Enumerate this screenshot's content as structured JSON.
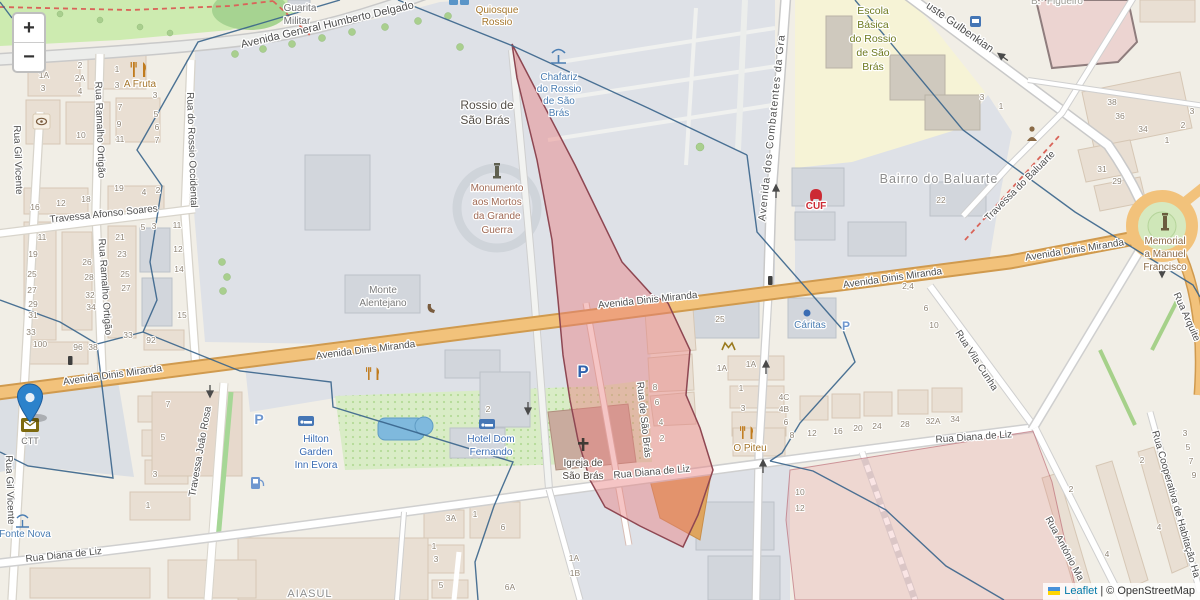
{
  "controls": {
    "zoom_in_label": "+",
    "zoom_out_label": "−"
  },
  "attribution": {
    "leaflet": "Leaflet",
    "sep": "|",
    "osm": "© OpenStreetMap"
  },
  "colors": {
    "base": "#f1eee6",
    "square_gray": "#dee1e7",
    "park_green": "#cdebb0",
    "school_yellow": "#f6f3d6",
    "road_primary": "#f2c27b",
    "pink_overlay": "#e87f7f",
    "pink_border": "#8e4752",
    "boundary_blue": "#38648b",
    "marker_blue": "#2c82cb"
  },
  "map_labels": [
    {
      "n": "street-humberto-delgado",
      "t": "Avenida General Humberto Delgado",
      "x": 328,
      "y": 28,
      "r": -13,
      "s": 11
    },
    {
      "n": "street-afonso-soares",
      "t": "Travessa Afonso Soares",
      "x": 104,
      "y": 217,
      "r": -6,
      "s": 10
    },
    {
      "n": "street-gil-vicente-north",
      "t": "Rua Gil Vicente",
      "x": 15,
      "y": 160,
      "r": 88,
      "s": 10
    },
    {
      "n": "street-gil-vicente-south",
      "t": "Rua Gil Vicente",
      "x": 7,
      "y": 490,
      "r": 88,
      "s": 10
    },
    {
      "n": "street-ramalho-ortigao-north",
      "t": "Rua Ramalho Ortigão",
      "x": 97,
      "y": 130,
      "r": 88,
      "s": 10
    },
    {
      "n": "street-ramalho-ortigao-south",
      "t": "Rua Ramalho Ortigão",
      "x": 102,
      "y": 287,
      "r": 86,
      "s": 10
    },
    {
      "n": "street-rossio-occidental",
      "t": "Rua do Rossio Occidental",
      "x": 189,
      "y": 150,
      "r": 88,
      "s": 10
    },
    {
      "n": "street-dinis-miranda-1",
      "t": "Avenida Dinis Miranda",
      "x": 113,
      "y": 378,
      "r": -8,
      "s": 10
    },
    {
      "n": "street-dinis-miranda-2",
      "t": "Avenida Dinis Miranda",
      "x": 366,
      "y": 353,
      "r": -7,
      "s": 10
    },
    {
      "n": "street-dinis-miranda-3",
      "t": "Avenida Dinis Miranda",
      "x": 648,
      "y": 303,
      "r": -6,
      "s": 10
    },
    {
      "n": "street-dinis-miranda-4",
      "t": "Avenida Dinis Miranda",
      "x": 893,
      "y": 281,
      "r": -8,
      "s": 10
    },
    {
      "n": "street-dinis-miranda-5",
      "t": "Avenida Dinis Miranda",
      "x": 1075,
      "y": 253,
      "r": -9,
      "s": 10
    },
    {
      "n": "street-combatentes",
      "t": "Avenida dos Combatentes da Gra",
      "x": 775,
      "y": 128,
      "r": -84,
      "s": 10.5,
      "sp": 1
    },
    {
      "n": "street-joao-rosa",
      "t": "Travessa João Rosa",
      "x": 203,
      "y": 452,
      "r": -80,
      "s": 10
    },
    {
      "n": "street-diana-liz-1",
      "t": "Rua Diana de Liz",
      "x": 64,
      "y": 558,
      "r": -6,
      "s": 10
    },
    {
      "n": "street-diana-liz-2",
      "t": "Rua Diana de Liz",
      "x": 652,
      "y": 475,
      "r": -5,
      "s": 10
    },
    {
      "n": "street-diana-liz-3",
      "t": "Rua Diana de Liz",
      "x": 974,
      "y": 440,
      "r": -4,
      "s": 10
    },
    {
      "n": "street-sao-bras",
      "t": "Rua de São Brás",
      "x": 641,
      "y": 420,
      "r": 84,
      "s": 10
    },
    {
      "n": "street-vila-cunha",
      "t": "Rua Vila Cunha",
      "x": 974,
      "y": 362,
      "r": 57,
      "s": 10
    },
    {
      "n": "street-gulbenkian",
      "t": "uste Gulbenkian",
      "x": 958,
      "y": 30,
      "r": 35,
      "s": 11
    },
    {
      "n": "street-travessa-baluarte",
      "t": "Travessa do Baluarte",
      "x": 1022,
      "y": 188,
      "r": -45,
      "s": 10
    },
    {
      "n": "street-arquiteto",
      "t": "Rua Arquite",
      "x": 1184,
      "y": 318,
      "r": 66,
      "s": 10
    },
    {
      "n": "street-antonio",
      "t": "Rua António Ma",
      "x": 1062,
      "y": 550,
      "r": 62,
      "s": 10
    },
    {
      "n": "street-cooperativa",
      "t": "Rua Cooperativa de Habitação Ha",
      "x": 1173,
      "y": 505,
      "r": 74,
      "s": 10
    },
    {
      "n": "poi-guarita-1",
      "t": "Guarita",
      "x": 300,
      "y": 11,
      "s": 10,
      "c": "#6f6f6f"
    },
    {
      "n": "poi-guarita-2",
      "t": "Militar",
      "x": 297,
      "y": 24,
      "s": 10,
      "c": "#6f6f6f"
    },
    {
      "n": "poi-quiosque-1",
      "t": "Quiosque",
      "x": 497,
      "y": 13,
      "s": 10,
      "c": "#a5762c"
    },
    {
      "n": "poi-quiosque-2",
      "t": "Rossio",
      "x": 497,
      "y": 25,
      "s": 10,
      "c": "#a5762c"
    },
    {
      "n": "poi-chafariz-1",
      "t": "Chafariz",
      "x": 559,
      "y": 80,
      "s": 10,
      "c": "#4a7db2"
    },
    {
      "n": "poi-chafariz-2",
      "t": "do Rossio",
      "x": 559,
      "y": 92,
      "s": 10,
      "c": "#4a7db2"
    },
    {
      "n": "poi-chafariz-3",
      "t": "de São",
      "x": 559,
      "y": 104,
      "s": 10,
      "c": "#4a7db2"
    },
    {
      "n": "poi-chafariz-4",
      "t": "Brás",
      "x": 559,
      "y": 116,
      "s": 10,
      "c": "#4a7db2"
    },
    {
      "n": "place-rossio-1",
      "t": "Rossio de",
      "x": 487,
      "y": 109,
      "s": 12,
      "c": "#554f48",
      "w": "500"
    },
    {
      "n": "place-rossio-2",
      "t": "São Brás",
      "x": 485,
      "y": 124,
      "s": 12,
      "c": "#554f48",
      "w": "500"
    },
    {
      "n": "poi-monumento-1",
      "t": "Monumento",
      "x": 497,
      "y": 191,
      "s": 10,
      "c": "#a06a55"
    },
    {
      "n": "poi-monumento-2",
      "t": "aos Mortos",
      "x": 497,
      "y": 205,
      "s": 10,
      "c": "#a06a55"
    },
    {
      "n": "poi-monumento-3",
      "t": "da Grande",
      "x": 497,
      "y": 219,
      "s": 10,
      "c": "#a06a55"
    },
    {
      "n": "poi-monumento-4",
      "t": "Guerra",
      "x": 497,
      "y": 233,
      "s": 10,
      "c": "#a06a55"
    },
    {
      "n": "poi-monte-1",
      "t": "Monte",
      "x": 383,
      "y": 293,
      "s": 10,
      "c": "#7a7a7a"
    },
    {
      "n": "poi-monte-2",
      "t": "Alentejano",
      "x": 383,
      "y": 306,
      "s": 10,
      "c": "#7a7a7a"
    },
    {
      "n": "poi-escola-1",
      "t": "Escola",
      "x": 873,
      "y": 14,
      "s": 10.5,
      "c": "#6e7a1f"
    },
    {
      "n": "poi-escola-2",
      "t": "Básica",
      "x": 873,
      "y": 28,
      "s": 10.5,
      "c": "#6e7a1f"
    },
    {
      "n": "poi-escola-3",
      "t": "do Rossio",
      "x": 873,
      "y": 42,
      "s": 10.5,
      "c": "#6e7a1f"
    },
    {
      "n": "poi-escola-4",
      "t": "de São",
      "x": 873,
      "y": 56,
      "s": 10.5,
      "c": "#6e7a1f"
    },
    {
      "n": "poi-escola-5",
      "t": "Brás",
      "x": 873,
      "y": 70,
      "s": 10.5,
      "c": "#6e7a1f"
    },
    {
      "n": "place-bairro-baluarte",
      "t": "Bairro do Baluarte",
      "x": 939,
      "y": 183,
      "s": 12.5,
      "c": "#8d8d8d",
      "sp": 1
    },
    {
      "n": "place-bairro-figueiro",
      "t": "B.º Figueiro",
      "x": 1057,
      "y": 4,
      "s": 10,
      "c": "#9c9c94"
    },
    {
      "n": "poi-cuf",
      "t": "CUF",
      "x": 816,
      "y": 209,
      "s": 10,
      "c": "#cc2a33",
      "w": "bold"
    },
    {
      "n": "poi-caritas",
      "t": "Cáritas",
      "x": 810,
      "y": 328,
      "s": 10,
      "c": "#4a7db2"
    },
    {
      "n": "poi-memorial-1",
      "t": "Memorial",
      "x": 1165,
      "y": 244,
      "s": 10,
      "c": "#8a6a46"
    },
    {
      "n": "poi-memorial-2",
      "t": "a Manuel",
      "x": 1165,
      "y": 257,
      "s": 10,
      "c": "#8a6a46"
    },
    {
      "n": "poi-memorial-3",
      "t": "Francisco",
      "x": 1165,
      "y": 270,
      "s": 10,
      "c": "#8a6a46"
    },
    {
      "n": "poi-hilton-1",
      "t": "Hilton",
      "x": 316,
      "y": 442,
      "s": 10,
      "c": "#3a6cb3"
    },
    {
      "n": "poi-hilton-2",
      "t": "Garden",
      "x": 316,
      "y": 455,
      "s": 10,
      "c": "#3a6cb3"
    },
    {
      "n": "poi-hilton-3",
      "t": "Inn Evora",
      "x": 316,
      "y": 468,
      "s": 10,
      "c": "#3a6cb3"
    },
    {
      "n": "poi-hotel-df-1",
      "t": "Hotel Dom",
      "x": 491,
      "y": 442,
      "s": 10,
      "c": "#3a6cb3"
    },
    {
      "n": "poi-hotel-df-2",
      "t": "Fernando",
      "x": 491,
      "y": 455,
      "s": 10,
      "c": "#3a6cb3"
    },
    {
      "n": "poi-igreja-1",
      "t": "Igreja de",
      "x": 583,
      "y": 466,
      "s": 10,
      "c": "#4a443e"
    },
    {
      "n": "poi-igreja-2",
      "t": "São Brás",
      "x": 583,
      "y": 479,
      "s": 10,
      "c": "#4a443e"
    },
    {
      "n": "poi-o-piteu",
      "t": "O Piteu",
      "x": 750,
      "y": 451,
      "s": 10,
      "c": "#a5762c"
    },
    {
      "n": "poi-a-fruta",
      "t": "A Fruta",
      "x": 140,
      "y": 87,
      "s": 10,
      "c": "#a5762c"
    },
    {
      "n": "place-aiasul",
      "t": "AIASUL",
      "x": 310,
      "y": 597,
      "s": 11,
      "c": "#8d8d8d",
      "sp": 1
    },
    {
      "n": "poi-ctt",
      "t": "CTT",
      "x": 30,
      "y": 444,
      "s": 9,
      "c": "#6f6f6f"
    },
    {
      "n": "poi-fonte-nova",
      "t": "Fonte Nova",
      "x": 25,
      "y": 537,
      "s": 10,
      "c": "#4a7db2"
    },
    {
      "n": "parking-p-1",
      "t": "P",
      "x": 583,
      "y": 377,
      "s": 17,
      "c": "#2f62ad",
      "w": "bold"
    },
    {
      "n": "parking-p-2",
      "t": "P",
      "x": 259,
      "y": 424,
      "s": 14,
      "c": "#6f97cf",
      "w": "bold"
    },
    {
      "n": "parking-p-3",
      "t": "P",
      "x": 846,
      "y": 330,
      "s": 12,
      "c": "#6f97cf",
      "w": "bold"
    }
  ],
  "house_numbers": [
    [
      "2",
      80,
      68
    ],
    [
      "2A",
      80,
      81
    ],
    [
      "1A",
      44,
      78
    ],
    [
      "3",
      43,
      91
    ],
    [
      "4",
      80,
      94
    ],
    [
      "1",
      117,
      72
    ],
    [
      "3",
      117,
      88
    ],
    [
      "3",
      155,
      98
    ],
    [
      "5",
      156,
      117
    ],
    [
      "6",
      157,
      130
    ],
    [
      "7",
      157,
      143
    ],
    [
      "7",
      120,
      110
    ],
    [
      "9",
      119,
      127
    ],
    [
      "11",
      120,
      142
    ],
    [
      "10",
      81,
      138
    ],
    [
      "16",
      35,
      210
    ],
    [
      "12",
      61,
      206
    ],
    [
      "18",
      86,
      202
    ],
    [
      "19",
      119,
      191
    ],
    [
      "4",
      144,
      195
    ],
    [
      "2",
      158,
      193
    ],
    [
      "11",
      42,
      240
    ],
    [
      "19",
      33,
      257
    ],
    [
      "25",
      32,
      277
    ],
    [
      "27",
      32,
      293
    ],
    [
      "29",
      33,
      307
    ],
    [
      "31",
      33,
      318
    ],
    [
      "33",
      31,
      335
    ],
    [
      "100",
      40,
      347
    ],
    [
      "26",
      87,
      265
    ],
    [
      "28",
      89,
      280
    ],
    [
      "32",
      90,
      298
    ],
    [
      "34",
      91,
      310
    ],
    [
      "96",
      78,
      350
    ],
    [
      "38",
      93,
      350
    ],
    [
      "21",
      120,
      240
    ],
    [
      "23",
      122,
      257
    ],
    [
      "25",
      125,
      277
    ],
    [
      "27",
      126,
      291
    ],
    [
      "33",
      128,
      338
    ],
    [
      "92",
      151,
      343
    ],
    [
      "5",
      143,
      230
    ],
    [
      "3",
      154,
      229
    ],
    [
      "11",
      177,
      228
    ],
    [
      "12",
      178,
      252
    ],
    [
      "14",
      179,
      272
    ],
    [
      "15",
      182,
      318
    ],
    [
      "7",
      168,
      407
    ],
    [
      "5",
      163,
      440
    ],
    [
      "3",
      155,
      477
    ],
    [
      "1",
      148,
      508
    ],
    [
      "3A",
      451,
      521
    ],
    [
      "1",
      475,
      517
    ],
    [
      "1",
      434,
      549
    ],
    [
      "3",
      436,
      562
    ],
    [
      "5",
      441,
      588
    ],
    [
      "6",
      503,
      530
    ],
    [
      "6A",
      510,
      590
    ],
    [
      "1A",
      574,
      561
    ],
    [
      "1B",
      575,
      576
    ],
    [
      "2",
      488,
      412
    ],
    [
      "8",
      655,
      390
    ],
    [
      "6",
      657,
      405
    ],
    [
      "4",
      661,
      425
    ],
    [
      "2",
      662,
      441
    ],
    [
      "25",
      720,
      322
    ],
    [
      "1A",
      722,
      371
    ],
    [
      "1A",
      751,
      367
    ],
    [
      "1",
      741,
      391
    ],
    [
      "3",
      743,
      411
    ],
    [
      "4C",
      784,
      400
    ],
    [
      "4B",
      784,
      412
    ],
    [
      "6",
      786,
      425
    ],
    [
      "8",
      792,
      438
    ],
    [
      "12",
      812,
      436
    ],
    [
      "16",
      838,
      434
    ],
    [
      "20",
      858,
      431
    ],
    [
      "24",
      877,
      429
    ],
    [
      "28",
      905,
      427
    ],
    [
      "32A",
      933,
      424
    ],
    [
      "34",
      955,
      422
    ],
    [
      "10",
      800,
      495
    ],
    [
      "12",
      800,
      511
    ],
    [
      "2,4",
      908,
      289
    ],
    [
      "6",
      926,
      311
    ],
    [
      "10",
      934,
      328
    ],
    [
      "22",
      941,
      203
    ],
    [
      "38",
      1112,
      105
    ],
    [
      "36",
      1120,
      119
    ],
    [
      "34",
      1143,
      132
    ],
    [
      "1",
      1167,
      143
    ],
    [
      "2",
      1183,
      128
    ],
    [
      "3",
      1192,
      114
    ],
    [
      "3",
      982,
      100
    ],
    [
      "1",
      1001,
      109
    ],
    [
      "31",
      1102,
      172
    ],
    [
      "29",
      1117,
      184
    ],
    [
      "3",
      1185,
      436
    ],
    [
      "5",
      1188,
      450
    ],
    [
      "7",
      1191,
      464
    ],
    [
      "9",
      1194,
      478
    ],
    [
      "2",
      1071,
      492
    ],
    [
      "4",
      1107,
      557
    ],
    [
      "2",
      1142,
      463
    ],
    [
      "4",
      1159,
      530
    ]
  ]
}
